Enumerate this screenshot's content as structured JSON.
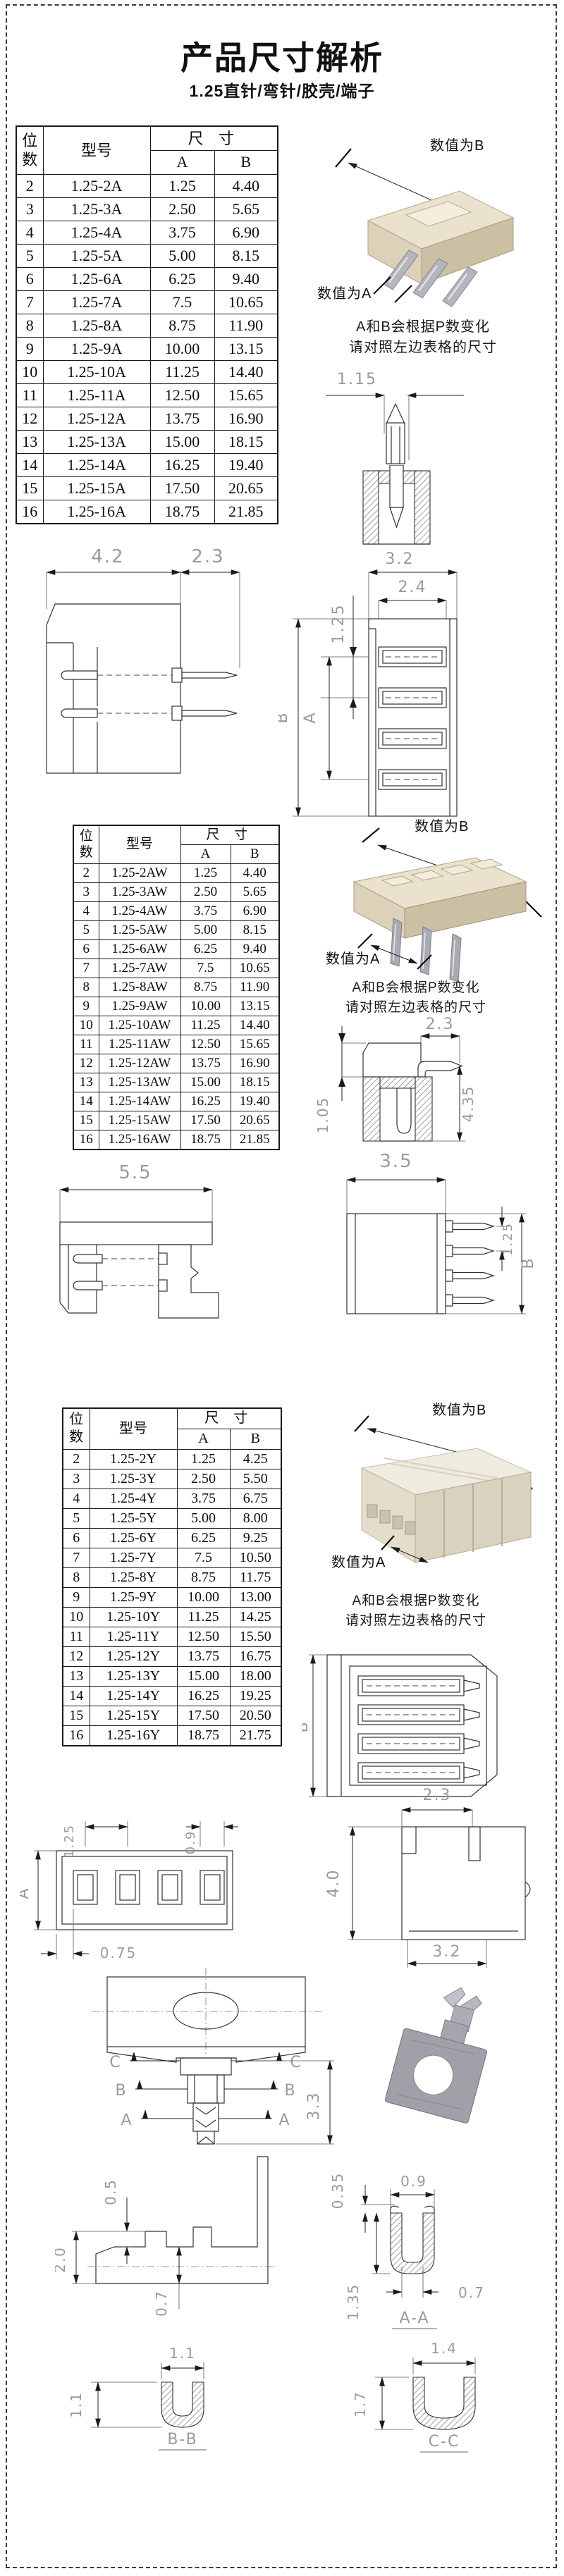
{
  "page": {
    "title": "产品尺寸解析",
    "subtitle": "1.25直针/弯针/胶壳/端子"
  },
  "labels": {
    "value_b": "数值为B",
    "value_a": "数值为A"
  },
  "note": {
    "line1": "A和B会根据P数变化",
    "line2": "请对照左边表格的尺寸"
  },
  "table_header": {
    "pos": "位数",
    "model": "型号",
    "size": "尺 寸",
    "a": "A",
    "b": "B"
  },
  "tables": [
    {
      "rows": [
        [
          "2",
          "1.25-2A",
          "1.25",
          "4.40"
        ],
        [
          "3",
          "1.25-3A",
          "2.50",
          "5.65"
        ],
        [
          "4",
          "1.25-4A",
          "3.75",
          "6.90"
        ],
        [
          "5",
          "1.25-5A",
          "5.00",
          "8.15"
        ],
        [
          "6",
          "1.25-6A",
          "6.25",
          "9.40"
        ],
        [
          "7",
          "1.25-7A",
          "7.5",
          "10.65"
        ],
        [
          "8",
          "1.25-8A",
          "8.75",
          "11.90"
        ],
        [
          "9",
          "1.25-9A",
          "10.00",
          "13.15"
        ],
        [
          "10",
          "1.25-10A",
          "11.25",
          "14.40"
        ],
        [
          "11",
          "1.25-11A",
          "12.50",
          "15.65"
        ],
        [
          "12",
          "1.25-12A",
          "13.75",
          "16.90"
        ],
        [
          "13",
          "1.25-13A",
          "15.00",
          "18.15"
        ],
        [
          "14",
          "1.25-14A",
          "16.25",
          "19.40"
        ],
        [
          "15",
          "1.25-15A",
          "17.50",
          "20.65"
        ],
        [
          "16",
          "1.25-16A",
          "18.75",
          "21.85"
        ]
      ]
    },
    {
      "rows": [
        [
          "2",
          "1.25-2AW",
          "1.25",
          "4.40"
        ],
        [
          "3",
          "1.25-3AW",
          "2.50",
          "5.65"
        ],
        [
          "4",
          "1.25-4AW",
          "3.75",
          "6.90"
        ],
        [
          "5",
          "1.25-5AW",
          "5.00",
          "8.15"
        ],
        [
          "6",
          "1.25-6AW",
          "6.25",
          "9.40"
        ],
        [
          "7",
          "1.25-7AW",
          "7.5",
          "10.65"
        ],
        [
          "8",
          "1.25-8AW",
          "8.75",
          "11.90"
        ],
        [
          "9",
          "1.25-9AW",
          "10.00",
          "13.15"
        ],
        [
          "10",
          "1.25-10AW",
          "11.25",
          "14.40"
        ],
        [
          "11",
          "1.25-11AW",
          "12.50",
          "15.65"
        ],
        [
          "12",
          "1.25-12AW",
          "13.75",
          "16.90"
        ],
        [
          "13",
          "1.25-13AW",
          "15.00",
          "18.15"
        ],
        [
          "14",
          "1.25-14AW",
          "16.25",
          "19.40"
        ],
        [
          "15",
          "1.25-15AW",
          "17.50",
          "20.65"
        ],
        [
          "16",
          "1.25-16AW",
          "18.75",
          "21.85"
        ]
      ]
    },
    {
      "rows": [
        [
          "2",
          "1.25-2Y",
          "1.25",
          "4.25"
        ],
        [
          "3",
          "1.25-3Y",
          "2.50",
          "5.50"
        ],
        [
          "4",
          "1.25-4Y",
          "3.75",
          "6.75"
        ],
        [
          "5",
          "1.25-5Y",
          "5.00",
          "8.00"
        ],
        [
          "6",
          "1.25-6Y",
          "6.25",
          "9.25"
        ],
        [
          "7",
          "1.25-7Y",
          "7.5",
          "10.50"
        ],
        [
          "8",
          "1.25-8Y",
          "8.75",
          "11.75"
        ],
        [
          "9",
          "1.25-9Y",
          "10.00",
          "13.00"
        ],
        [
          "10",
          "1.25-10Y",
          "11.25",
          "14.25"
        ],
        [
          "11",
          "1.25-11Y",
          "12.50",
          "15.50"
        ],
        [
          "12",
          "1.25-12Y",
          "13.75",
          "16.75"
        ],
        [
          "13",
          "1.25-13Y",
          "15.00",
          "18.00"
        ],
        [
          "14",
          "1.25-14Y",
          "16.25",
          "19.25"
        ],
        [
          "15",
          "1.25-15Y",
          "17.50",
          "20.50"
        ],
        [
          "16",
          "1.25-16Y",
          "18.75",
          "21.75"
        ]
      ]
    }
  ],
  "dims": {
    "dim_a": "A",
    "dim_b": "B",
    "pin_width": "1.15",
    "s1_body_w": "4.2",
    "s1_pin_len": "2.3",
    "s1_top_w": "3.2",
    "s1_inner_w": "2.4",
    "s1_pitch": "1.25",
    "s2_pin_len": "2.3",
    "s2_step_h": "1.05",
    "s2_total_h": "4.35",
    "s2_body_w": "5.5",
    "s2_front_w": "3.5",
    "s2_pitch": "1.25",
    "s3_pitch": "1.25",
    "s3_slot_w": "0.9",
    "s3_edge": "0.75",
    "s3_top_w": "2.3",
    "s3_height": "4.0",
    "s3_bottom_w": "3.2",
    "s4_height": "3.3",
    "sec_c": "C",
    "sec_b": "B",
    "sec_a": "A",
    "t_step": "0.5",
    "t_height": "2.0",
    "t_depth": "0.7",
    "aa_wall": "0.35",
    "aa_w": "0.9",
    "aa_inner_w": "0.7",
    "aa_h": "1.35",
    "aa_label": "A-A",
    "bb_w": "1.1",
    "bb_h": "1.1",
    "bb_label": "B-B",
    "cc_w": "1.4",
    "cc_h": "1.7",
    "cc_label": "C-C"
  },
  "colors": {
    "connector_top": "#eae2cd",
    "connector_front": "#dcd2b9",
    "connector_side": "#cbc0a3",
    "terminal_metal": "#a5a5ad",
    "dim_text": "#9a9a9a"
  }
}
